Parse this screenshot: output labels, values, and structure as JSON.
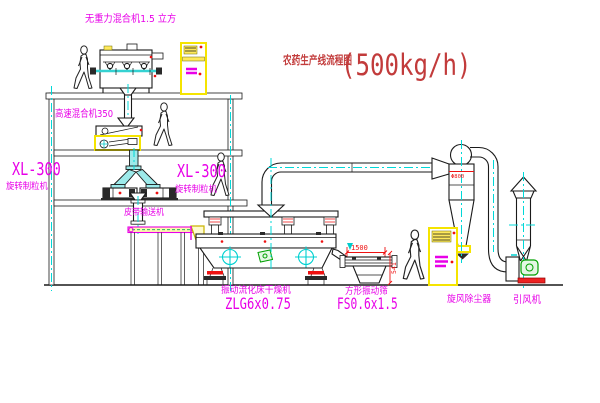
{
  "title": {
    "name": "农药生产线流程图",
    "capacity": "(500kg/h)"
  },
  "equipment_labels": {
    "gravity_mixer": "无重力混合机1.5 立方",
    "high_speed_mixer": "高速混合机350",
    "granulator_left_model": "XL-300",
    "granulator_left_name": "旋转制粒机",
    "granulator_right_model": "XL-300",
    "granulator_right_name": "旋转制粒机",
    "belt_conveyor": "皮带输送机",
    "fluid_bed_dryer": "振动流化床干燥机",
    "fluid_bed_dryer_model": "ZLG6x0.75",
    "vibrating_sieve": "方形振动筛",
    "vibrating_sieve_model": "FS0.6x1.5",
    "cyclone": "旋风除尘器",
    "induced_draft_fan": "引风机"
  },
  "dimensions": {
    "sieve_length": "1500",
    "sieve_height": "541",
    "cyclone_note": "Φ800"
  },
  "colors": {
    "label_magenta": "#e800e8",
    "dimension_red": "#ee1111",
    "title_red": "#c23b3b",
    "centerline_cyan": "#00d8d8",
    "highlight_yellow": "#f5e400",
    "line_black": "#1a1a1a",
    "motor_green": "#00a000"
  },
  "icons": {
    "worker": "worker-figure",
    "circle_cross": "vibration-motor-symbol"
  }
}
